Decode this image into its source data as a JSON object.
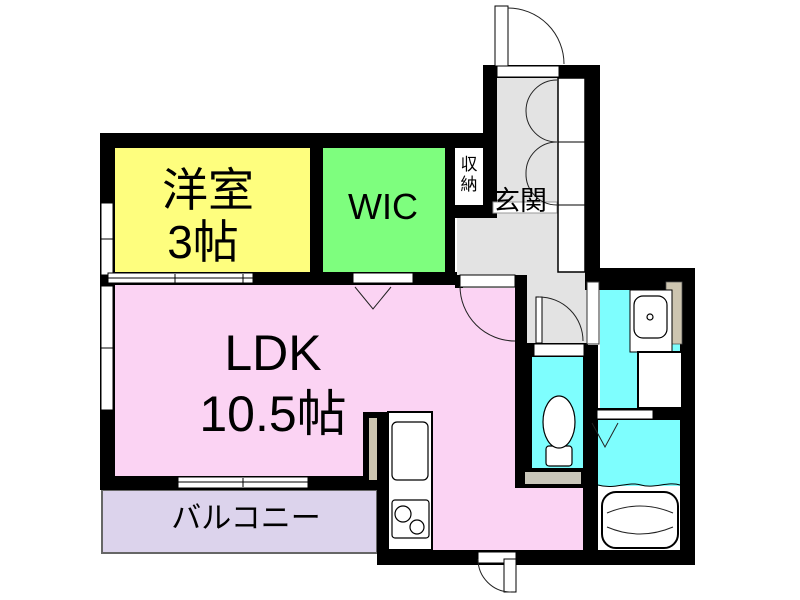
{
  "floorplan": {
    "wall_color": "#000000",
    "rooms": {
      "western_room": {
        "name": "洋室",
        "size": "3帖",
        "color": "#fefe7e"
      },
      "wic": {
        "name": "WIC",
        "color": "#7efe7e"
      },
      "ldk": {
        "name": "LDK",
        "size": "10.5帖",
        "color": "#fbd3f3"
      },
      "balcony": {
        "name": "バルコニー",
        "color": "#dcd3ec"
      },
      "entrance": {
        "name": "玄関",
        "color": "#e3e3e3"
      },
      "hallway": {
        "color": "#e3e3e3"
      },
      "storage": {
        "name": "収納",
        "char1": "収",
        "char2": "納",
        "color": "#ffffff"
      },
      "toilet_room": {
        "color": "#7efefe"
      },
      "washroom": {
        "color": "#7efefe"
      },
      "bathroom": {
        "color": "#7efefe"
      }
    },
    "accents": {
      "threshold": "#c9c6ba",
      "pipe_space": "#cdc5b0",
      "balcony_border": "#666666"
    },
    "fixtures": [
      "entry-door",
      "shoe-cabinet",
      "toilet",
      "washbasin",
      "washing-machine-pan",
      "bathtub",
      "kitchen-sink",
      "gas-stove",
      "sliding-window",
      "folding-door"
    ]
  }
}
